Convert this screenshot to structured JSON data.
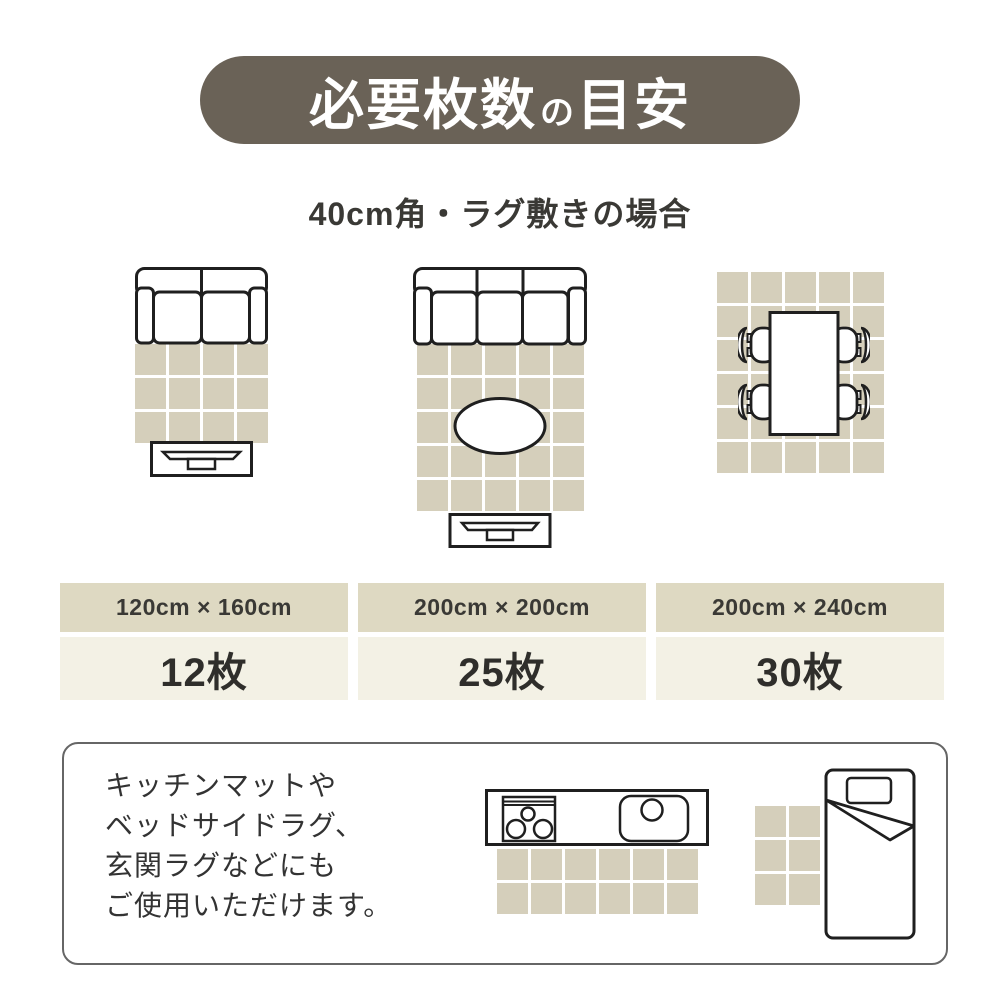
{
  "title": {
    "part1": "必要枚数",
    "particle": "の",
    "part2": "目安"
  },
  "subtitle": "40cm角・ラグ敷きの場合",
  "scenarios": [
    {
      "size": "120cm × 160cm",
      "count": "12枚",
      "grid_cols": 4,
      "grid_rows": 3
    },
    {
      "size": "200cm × 200cm",
      "count": "25枚",
      "grid_cols": 5,
      "grid_rows": 5
    },
    {
      "size": "200cm × 240cm",
      "count": "30枚",
      "grid_cols": 5,
      "grid_rows": 6
    }
  ],
  "note_lines": [
    "キッチンマットや",
    "ベッドサイドラグ、",
    "玄関ラグなどにも",
    "ご使用いただけます。"
  ],
  "extra_examples": {
    "kitchen_rug": {
      "grid_cols": 6,
      "grid_rows": 2
    },
    "bedside_rug": {
      "grid_cols": 2,
      "grid_rows": 3
    }
  },
  "colors": {
    "banner": "#6a6257",
    "banner_text": "#ffffff",
    "rug_tile": "#d5cfbb",
    "grid_line": "#ffffff",
    "table_header_bg": "#ded9c2",
    "table_value_bg": "#f3f1e5",
    "line": "#1f1f1f",
    "text_dark": "#3a3935",
    "note_text": "#333333",
    "box_border": "#666666"
  }
}
